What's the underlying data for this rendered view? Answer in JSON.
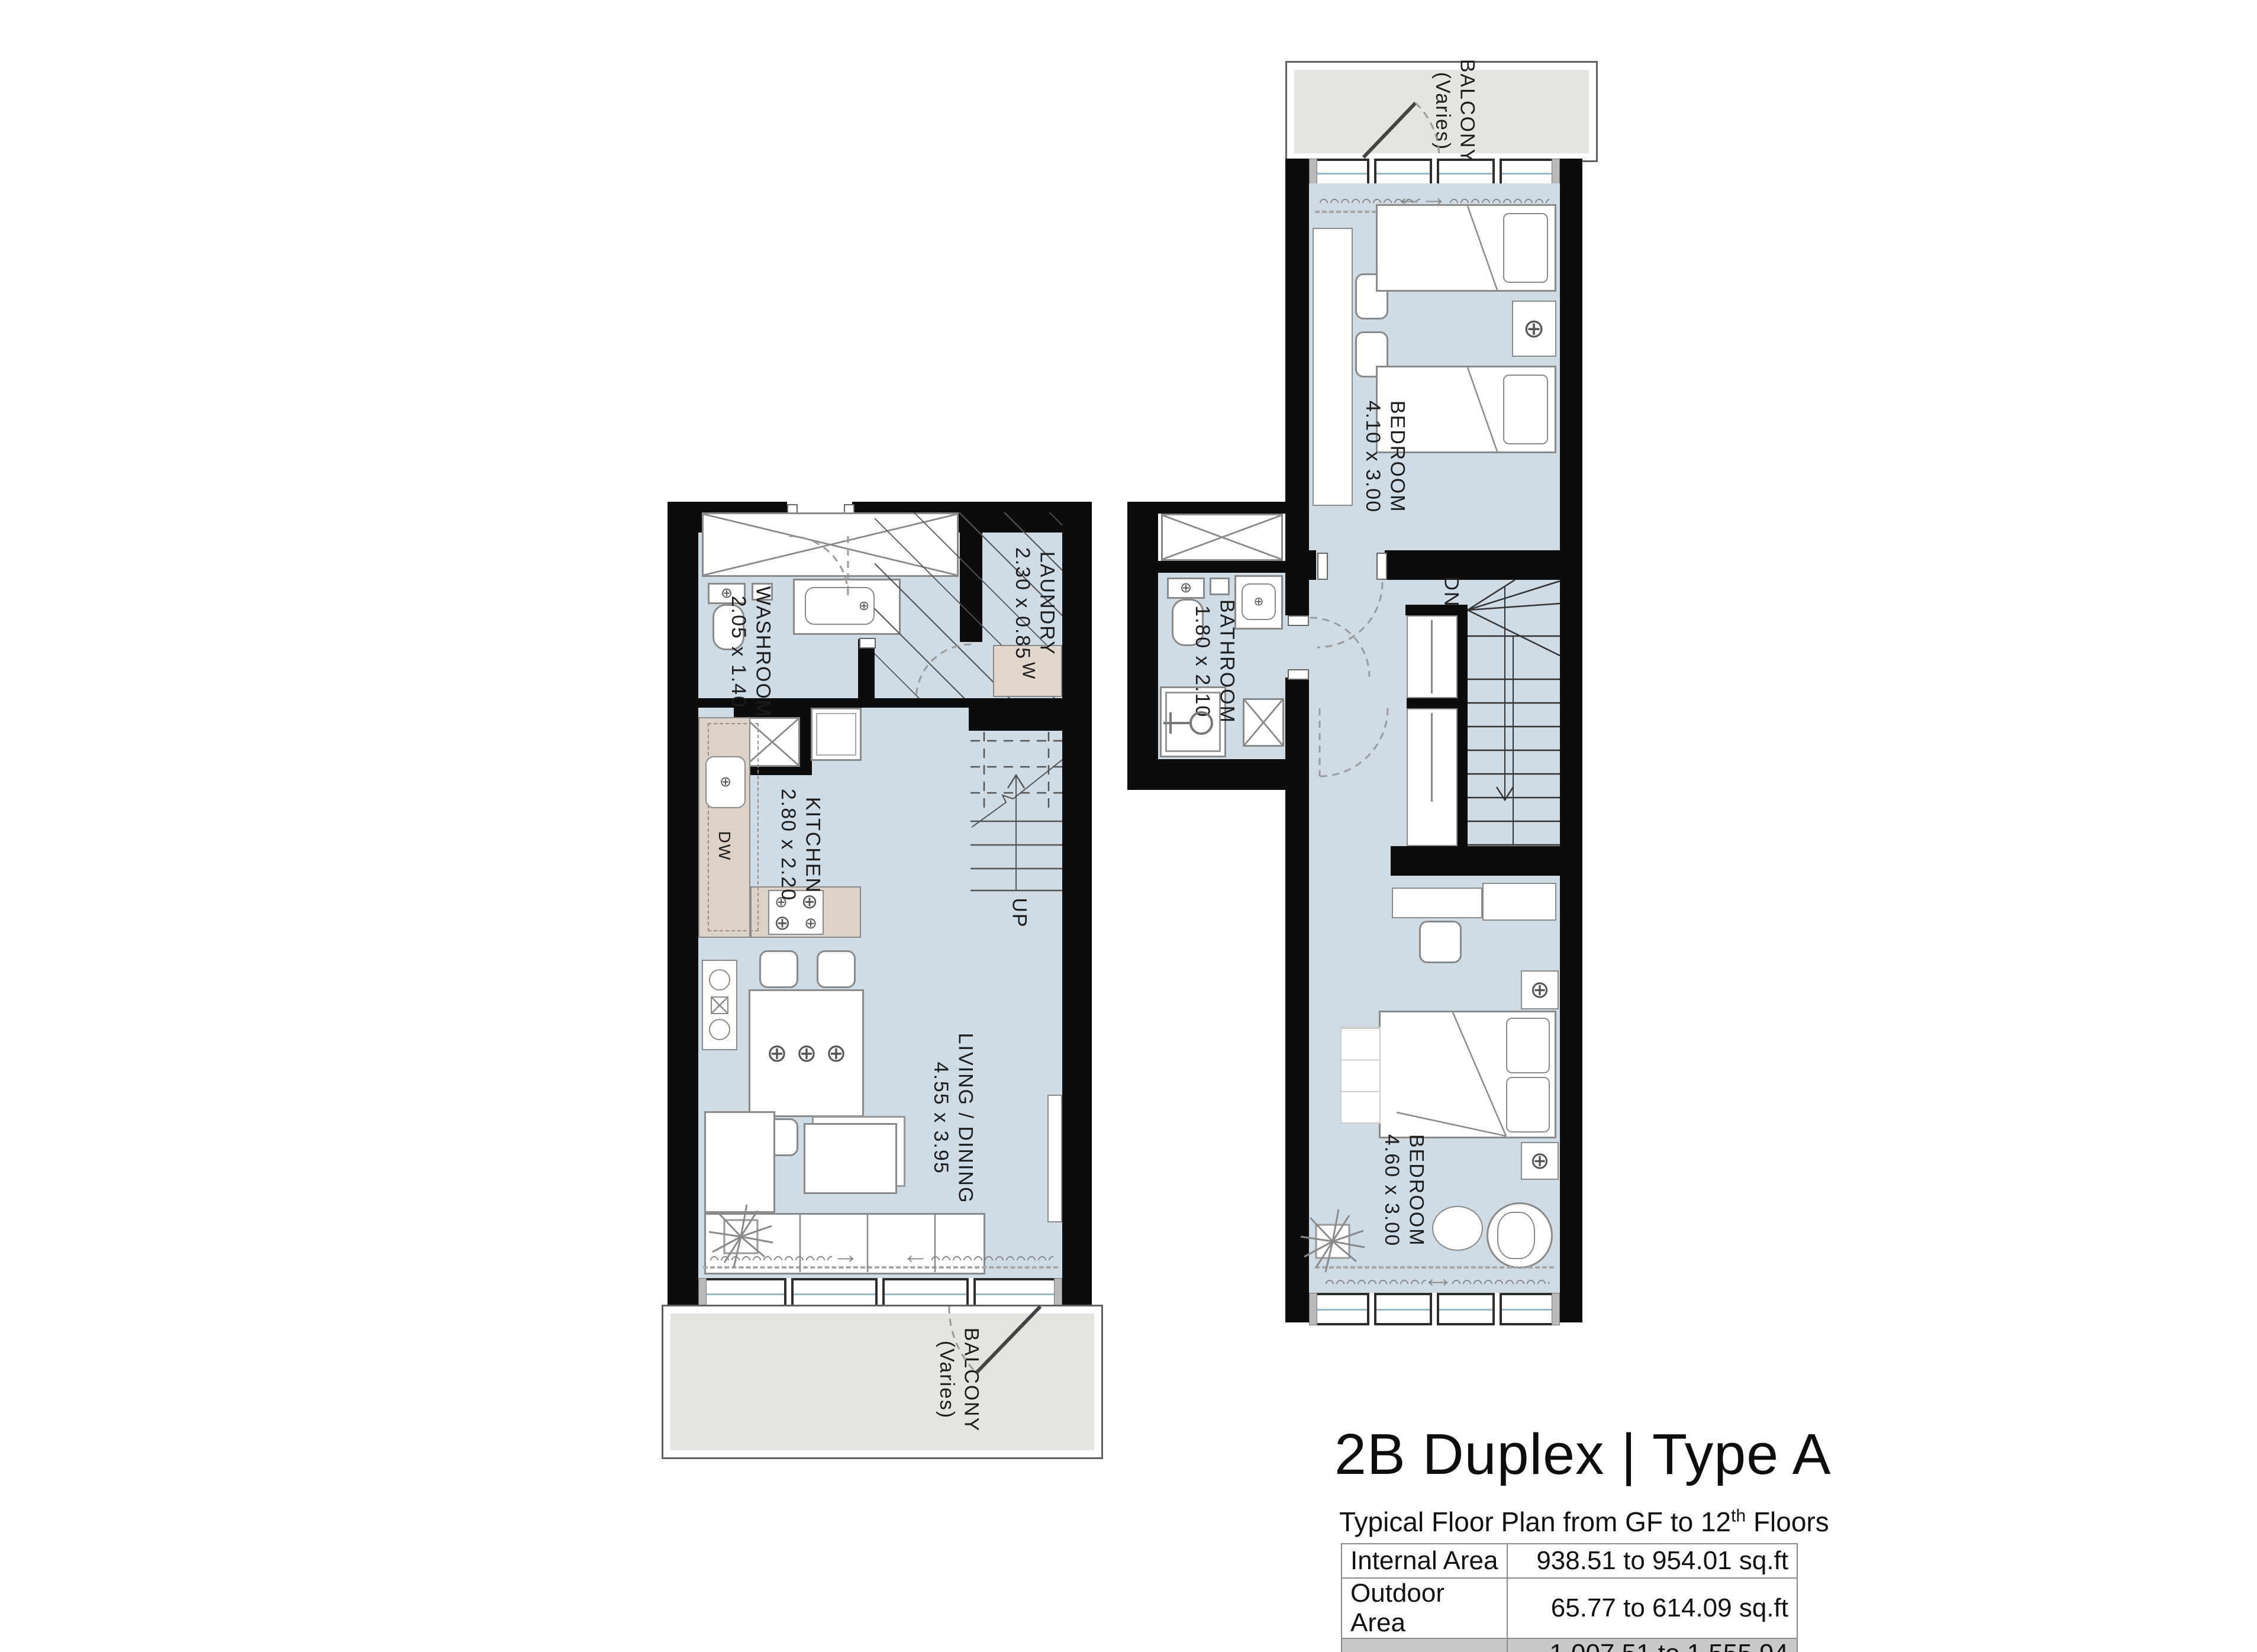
{
  "colors": {
    "wall": "#0c0c0c",
    "floor": "#cfdbe5",
    "balcony": "#e4e5e0",
    "counter": "#ddd2c8",
    "table_shade": "#c9c9c9",
    "line_gray": "#8a8a8a"
  },
  "symbols": {
    "light": "⊕",
    "arrow_right": "→",
    "arrow_left": "←"
  },
  "ground_floor": {
    "balcony_name": "BALCONY",
    "balcony_note": "(Varies)",
    "washroom_name": "WASHROOM",
    "washroom_dims": "2.05 x 1.40",
    "laundry_name": "LAUNDRY",
    "laundry_dims": "2.30 x 0.85",
    "kitchen_name": "KITCHEN",
    "kitchen_dims": "2.80 x 2.20",
    "living_name": "LIVING / DINING",
    "living_dims": "4.55 x 3.95",
    "stairs": "UP",
    "washer": "W",
    "dishwasher": "DW"
  },
  "upper_floor": {
    "balcony_name": "BALCONY",
    "balcony_note": "(Varies)",
    "bedroom1_name": "BEDROOM",
    "bedroom1_dims": "4.10 x 3.00",
    "bathroom_name": "BATHROOM",
    "bathroom_dims": "1.80 x 2.10",
    "bedroom2_name": "BEDROOM",
    "bedroom2_dims": "4.60 x 3.00",
    "stairs": "DN"
  },
  "title_block": {
    "title": "2B Duplex | Type A",
    "subtitle_prefix": "Typical Floor Plan from GF to 12",
    "subtitle_sup": "th",
    "subtitle_suffix": " Floors",
    "rows": [
      {
        "label": "Internal Area",
        "value": "938.51 to 954.01 sq.ft"
      },
      {
        "label": "Outdoor Area",
        "value": "65.77 to 614.09 sq.ft"
      },
      {
        "label": "Total Area",
        "value": "1,007.51 to 1,555.94 sq.ft"
      }
    ]
  }
}
